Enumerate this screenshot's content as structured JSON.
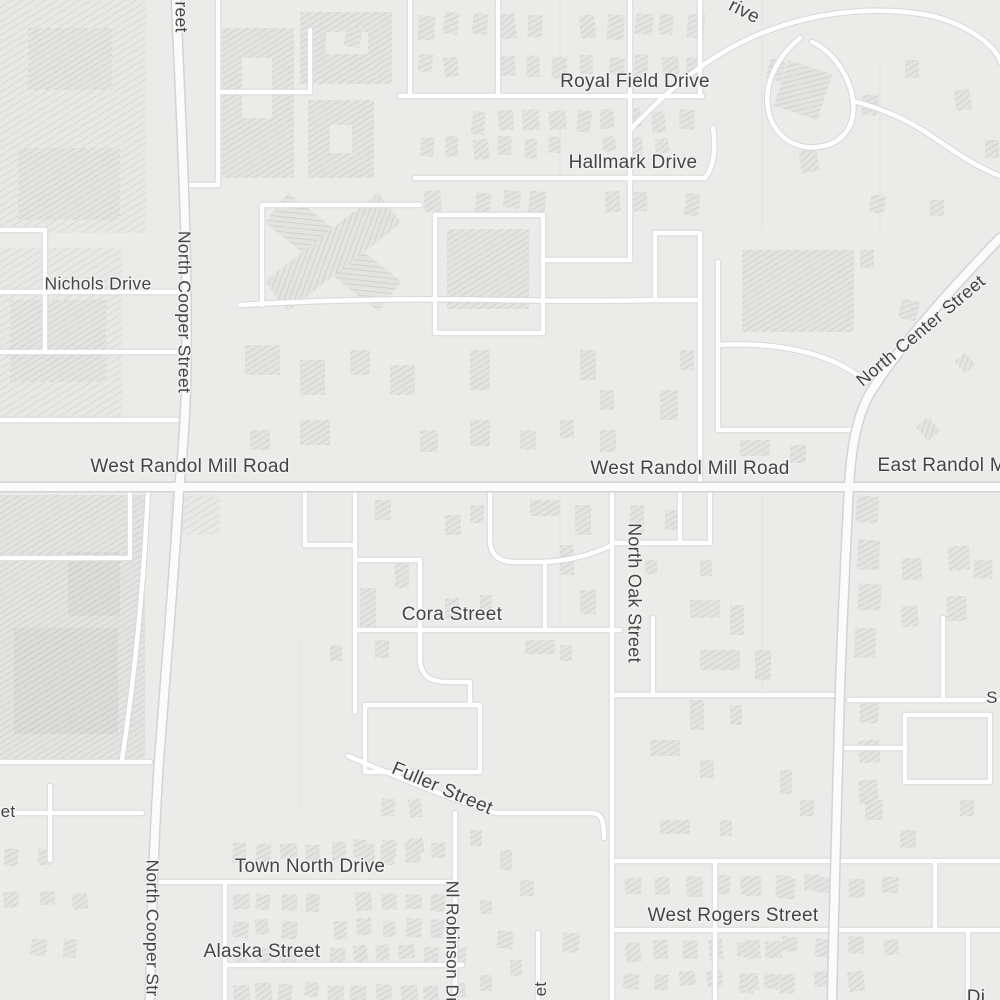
{
  "map": {
    "style": "light-gray-street-map",
    "colors": {
      "background": "#ebebe9",
      "road_fill": "#ffffff",
      "road_casing": "#d8d8d6",
      "major_road_fill": "#fbfbf9",
      "major_road_casing": "#d2d4d4",
      "building_fill": "#e2e2e0",
      "hatch_line": "#c9c9c7",
      "label_color": "#454545",
      "label_halo": "#f4f4f2"
    },
    "labels": {
      "royal_field_drive": "Royal Field Drive",
      "hallmark_drive": "Hallmark Drive",
      "nichols_drive": "Nichols Drive",
      "north_cooper_street": "North Cooper Street",
      "north_cooper_street_partial_top": "reet",
      "north_cooper_street_partial_bottom": "North Cooper Str",
      "west_randol_mill_road_west": "West Randol Mill Road",
      "west_randol_mill_road_east": "West Randol Mill Road",
      "east_randol_mill_road_partial": "East Randol Mi",
      "north_center_street": "North Center Street",
      "north_oak_street": "North Oak Street",
      "cora_street": "Cora Street",
      "fuller_street": "Fuller Street",
      "town_north_drive": "Town North Drive",
      "west_rogers_street": "West Rogers Street",
      "alaska_street": "Alaska Street",
      "nl_robinson_drive": "Nl Robinson Dr",
      "unnamed_drive_partial_top_right": "rive",
      "unnamed_street_partial_right_edge": "S",
      "unnamed_street_partial_left_edge": "et",
      "unnamed_street_partial_bottom_center": "et",
      "unnamed_partial_bottom_right": "Di"
    }
  }
}
